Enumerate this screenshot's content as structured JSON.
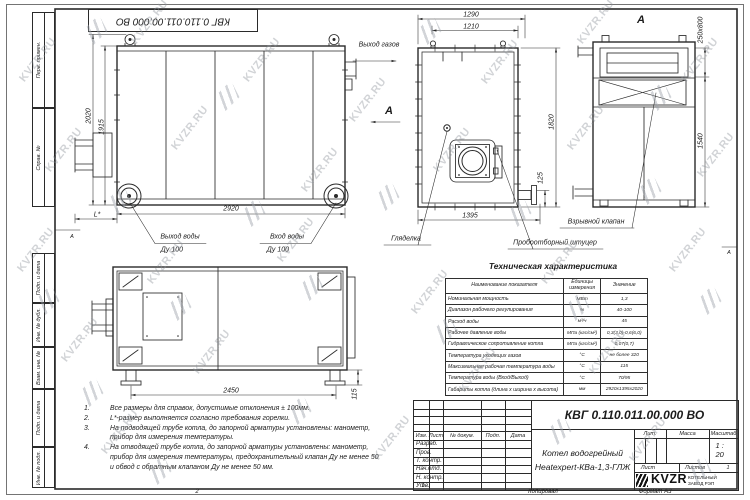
{
  "watermark": {
    "text": "KVZR.RU"
  },
  "frame": {
    "top_stamp": "КВГ 0.110.011.00.000 ВО",
    "left_fields": [
      "Перв. примен.",
      "Справ. №",
      "Подп. и дата",
      "Инв. № дубл.",
      "Взам. инв. №",
      "Подп. и дата",
      "Инв. № подл."
    ],
    "zone_letter": "А",
    "zone_1": "1",
    "zone_2": "2",
    "copy_label": "Копировал",
    "format_label": "Формат А3"
  },
  "views": {
    "side": {
      "dim_height": "2020",
      "dim_height2": "1915",
      "dim_width": "2920",
      "dim_l": "L*",
      "gas_out": "Выход газов",
      "section": "А",
      "water_out": "Выход воды",
      "water_out_dn": "Ду 100",
      "water_in": "Вход воды",
      "water_in_dn": "Ду 100"
    },
    "front": {
      "dim_1290": "1290",
      "dim_1210": "1210",
      "dim_1820": "1820",
      "dim_125": "125",
      "dim_1395": "1395",
      "sight": "Гляделка",
      "sampler": "Пробоотборный штуцер"
    },
    "a_view": {
      "label": "А",
      "dim_top": "250x800",
      "dim_h": "1540",
      "valve": "Взрывной клапан"
    },
    "plan": {
      "dim_w": "2450",
      "dim_h": "115"
    }
  },
  "tech_table": {
    "title": "Техническая характеристика",
    "headers": [
      "Наименование показателя",
      "Единицы измерения",
      "Значение"
    ],
    "rows": [
      {
        "name": "Номинальная мощность",
        "unit": "МВт",
        "value": "1,3"
      },
      {
        "name": "Диапазон рабочего регулирования",
        "unit": "%",
        "value": "40-100"
      },
      {
        "name": "Расход воды",
        "unit": "м³/ч",
        "value": "45"
      },
      {
        "name": "Рабочее давление воды",
        "unit": "МПа (кгс/см²)",
        "value": "0,3(3,0)-0,6(6,0)"
      },
      {
        "name": "Гидравлическое сопротивление котла",
        "unit": "МПа (кгс/см²)",
        "value": "0,07(0,7)"
      },
      {
        "name": "Температура уходящих газов",
        "unit": "°С",
        "value": "не более 320"
      },
      {
        "name": "Максимальная рабочая температура воды",
        "unit": "°С",
        "value": "115"
      },
      {
        "name": "Температура воды (Вход/Выход)",
        "unit": "°С",
        "value": "70/95"
      },
      {
        "name": "Габариты котла (длина х ширина х высота)",
        "unit": "мм",
        "value": "2920х1395х2020"
      }
    ]
  },
  "notes": {
    "items": [
      {
        "num": "1.",
        "text": "Все размеры для справок, допустимые отклонения ± 100мм."
      },
      {
        "num": "2.",
        "text": "L*-размер выполняется согласно требования горелки."
      },
      {
        "num": "3.",
        "text": "На подводящей трубе котла, до запорной арматуры установлены: манометр, прибор для измерения температуры."
      },
      {
        "num": "4.",
        "text": "На отводящей трубе котла, до запорной арматуры установлены: манометр, прибор для измерения температуры, предохранительный клапан Ду не менее 50 и обвод с обратным клапаном Ду не менее 50 мм."
      }
    ]
  },
  "title_block": {
    "doc_number": "КВГ 0.110.011.00.000 ВО",
    "product_line1": "Котел водогрейный",
    "product_line2": "Heatexpert-КВа-1,3-ГЛЖ",
    "col_headers": [
      "Изм.",
      "Лист",
      "№ докум.",
      "Подп.",
      "Дата"
    ],
    "sig_rows": [
      "Разраб.",
      "Пров.",
      "Т. контр.",
      "Нач.отд.",
      "Н. контр.",
      "Утв."
    ],
    "lit_label": "Лит.",
    "mass_label": "Масса",
    "scale_label": "Масштаб",
    "scale_value": "1 : 20",
    "sheet_label": "Лист",
    "sheets_label": "Листов",
    "sheets_value": "1",
    "brand": "KVZR",
    "company_line1": "КОТЕЛЬНЫЙ",
    "company_line2": "ЗАВОД РЭП"
  }
}
